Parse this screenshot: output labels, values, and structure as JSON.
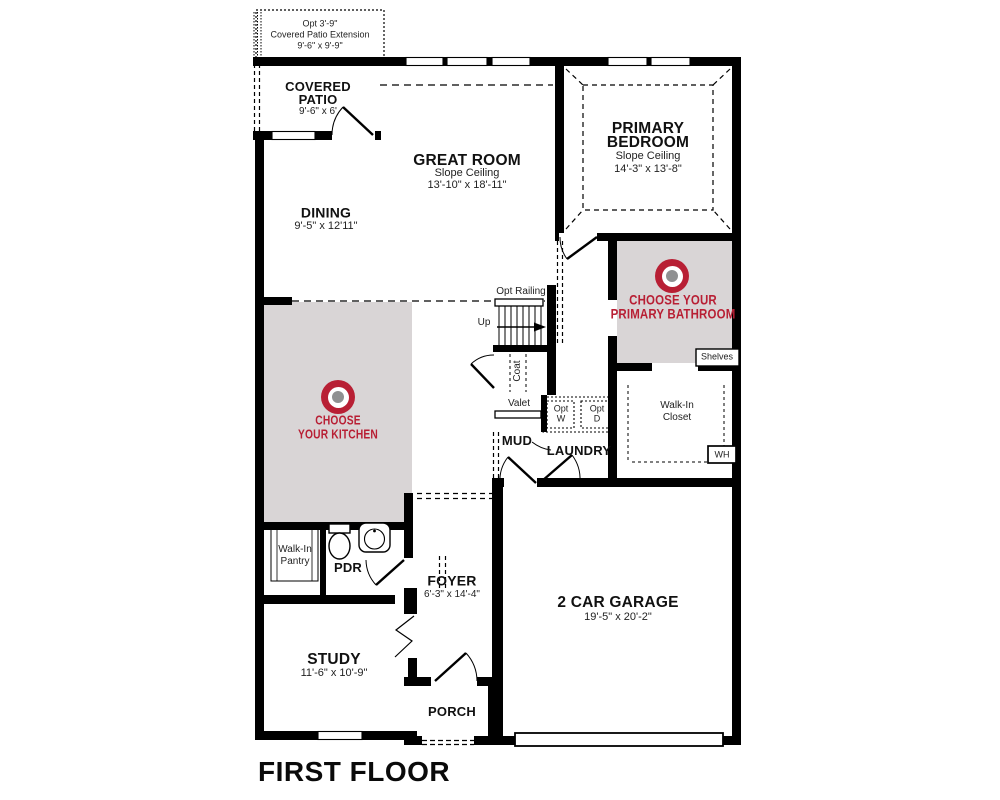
{
  "title": "FIRST FLOOR",
  "colors": {
    "accent_red": "#b81f34",
    "room_highlight": "#d9d5d6",
    "wall": "#000000"
  },
  "rooms": {
    "opt_patio_extension": {
      "line1": "Opt 3'-9\"",
      "line2": "Covered Patio Extension",
      "line3": "9'-6\" x 9'-9\""
    },
    "covered_patio": {
      "name1": "COVERED",
      "name2": "PATIO",
      "dims": "9'-6\" x 6'"
    },
    "great_room": {
      "name": "GREAT ROOM",
      "ceiling": "Slope Ceiling",
      "dims": "13'-10\" x 18'-11\""
    },
    "primary_bedroom": {
      "name1": "PRIMARY",
      "name2": "BEDROOM",
      "ceiling": "Slope Ceiling",
      "dims": "14'-3\" x 13'-8\""
    },
    "dining": {
      "name": "DINING",
      "dims": "9'-5\" x 12'11\""
    },
    "study": {
      "name": "STUDY",
      "dims": "11'-6\" x 10'-9\""
    },
    "foyer": {
      "name": "FOYER",
      "dims": "6'-3\" x 14'-4\""
    },
    "garage": {
      "name": "2 CAR GARAGE",
      "dims": "19'-5\" x 20'-2\""
    },
    "porch": {
      "name": "PORCH"
    },
    "mud": {
      "name": "MUD"
    },
    "laundry": {
      "name": "LAUNDRY"
    },
    "pdr": {
      "name": "PDR"
    },
    "walk_in_pantry": {
      "line1": "Walk-In",
      "line2": "Pantry"
    },
    "walk_in_closet": {
      "line1": "Walk-In",
      "line2": "Closet"
    },
    "coat": {
      "name": "Coat"
    },
    "valet": {
      "name": "Valet"
    },
    "shelves": {
      "name": "Shelves"
    },
    "water_heater": {
      "name": "WH"
    }
  },
  "callouts": {
    "kitchen": {
      "line1": "CHOOSE",
      "line2": "YOUR KITCHEN"
    },
    "primary_bathroom": {
      "line1": "CHOOSE YOUR",
      "line2": "PRIMARY BATHROOM"
    }
  },
  "stairs": {
    "railing": "Opt Railing",
    "direction": "Up"
  },
  "appliances": {
    "washer": {
      "line1": "Opt",
      "line2": "W"
    },
    "dryer": {
      "line1": "Opt",
      "line2": "D"
    }
  }
}
